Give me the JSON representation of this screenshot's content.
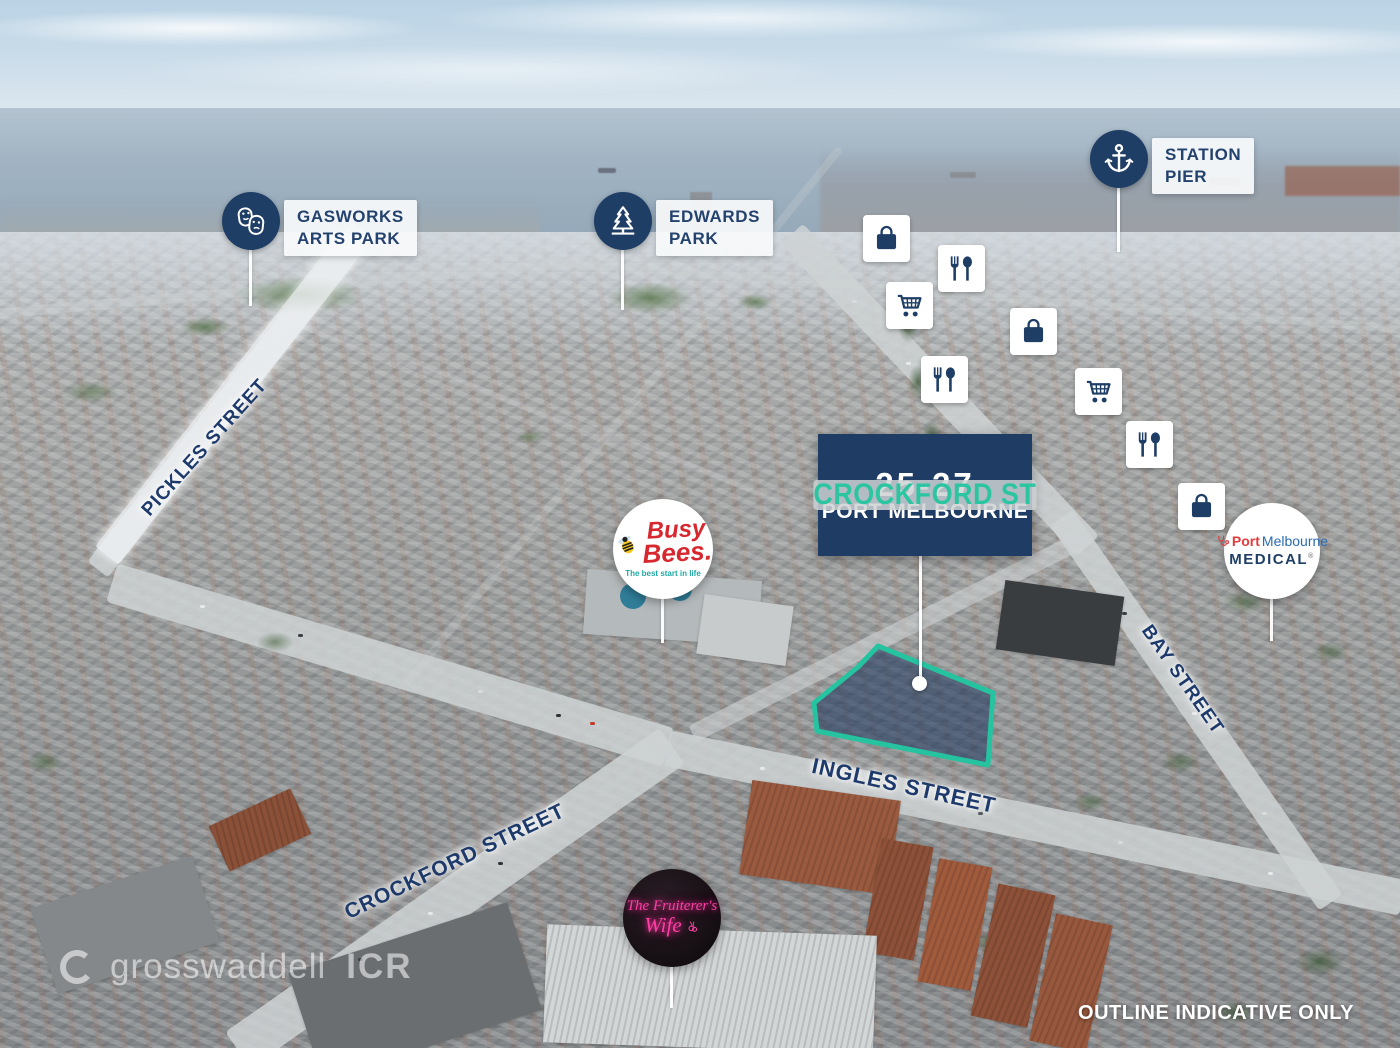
{
  "brand_colors": {
    "navy": "#1f3c64",
    "teal": "#2cc5a2",
    "label_text": "#24426e"
  },
  "property_badge": {
    "address_number": "25-27",
    "street": "CROCKFORD ST",
    "suburb": "PORT MELBOURNE"
  },
  "site_outline": {
    "stroke": "#25c3a0",
    "fill": "rgba(27,53,92,0.55)",
    "note": "highlighted subject property polygon"
  },
  "poi_labels": {
    "gasworks": {
      "line1": "GASWORKS",
      "line2": "ARTS PARK",
      "icon": "theater-masks"
    },
    "edwards": {
      "line1": "EDWARDS",
      "line2": "PARK",
      "icon": "pine-tree"
    },
    "station_pier": {
      "line1": "STATION",
      "line2": "PIER",
      "icon": "anchor"
    }
  },
  "street_labels": {
    "pickles": "PICKLES STREET",
    "bay": "BAY STREET",
    "ingles": "INGLES STREET",
    "crockford": "CROCKFORD STREET"
  },
  "businesses": {
    "busy_bees": {
      "line1": "Busy",
      "line2": "Bees.",
      "tagline": "The best start in life",
      "color": "#d7282f",
      "icon": "bee"
    },
    "port_melbourne_medical": {
      "word1": "Port",
      "word2": "Melbourne",
      "line2": "MEDICAL",
      "reg": "®",
      "icon": "stethoscope"
    },
    "fruiterers_wife": {
      "line1": "The Fruiterer's",
      "line2": "Wife",
      "color": "#ff3fa6",
      "icon": "cherries"
    }
  },
  "amenity_icons": [
    {
      "type": "shopping-bag",
      "x": 863,
      "y": 215
    },
    {
      "type": "restaurant",
      "x": 938,
      "y": 245
    },
    {
      "type": "shopping-cart",
      "x": 886,
      "y": 282
    },
    {
      "type": "restaurant",
      "x": 921,
      "y": 356
    },
    {
      "type": "shopping-bag",
      "x": 1010,
      "y": 308
    },
    {
      "type": "shopping-cart",
      "x": 1075,
      "y": 368
    },
    {
      "type": "restaurant",
      "x": 1126,
      "y": 421
    },
    {
      "type": "shopping-bag",
      "x": 1178,
      "y": 483
    }
  ],
  "watermark": {
    "brand": "grosswaddell",
    "suffix": "ICR",
    "icon": "ring-logo"
  },
  "disclaimer": "OUTLINE INDICATIVE ONLY"
}
